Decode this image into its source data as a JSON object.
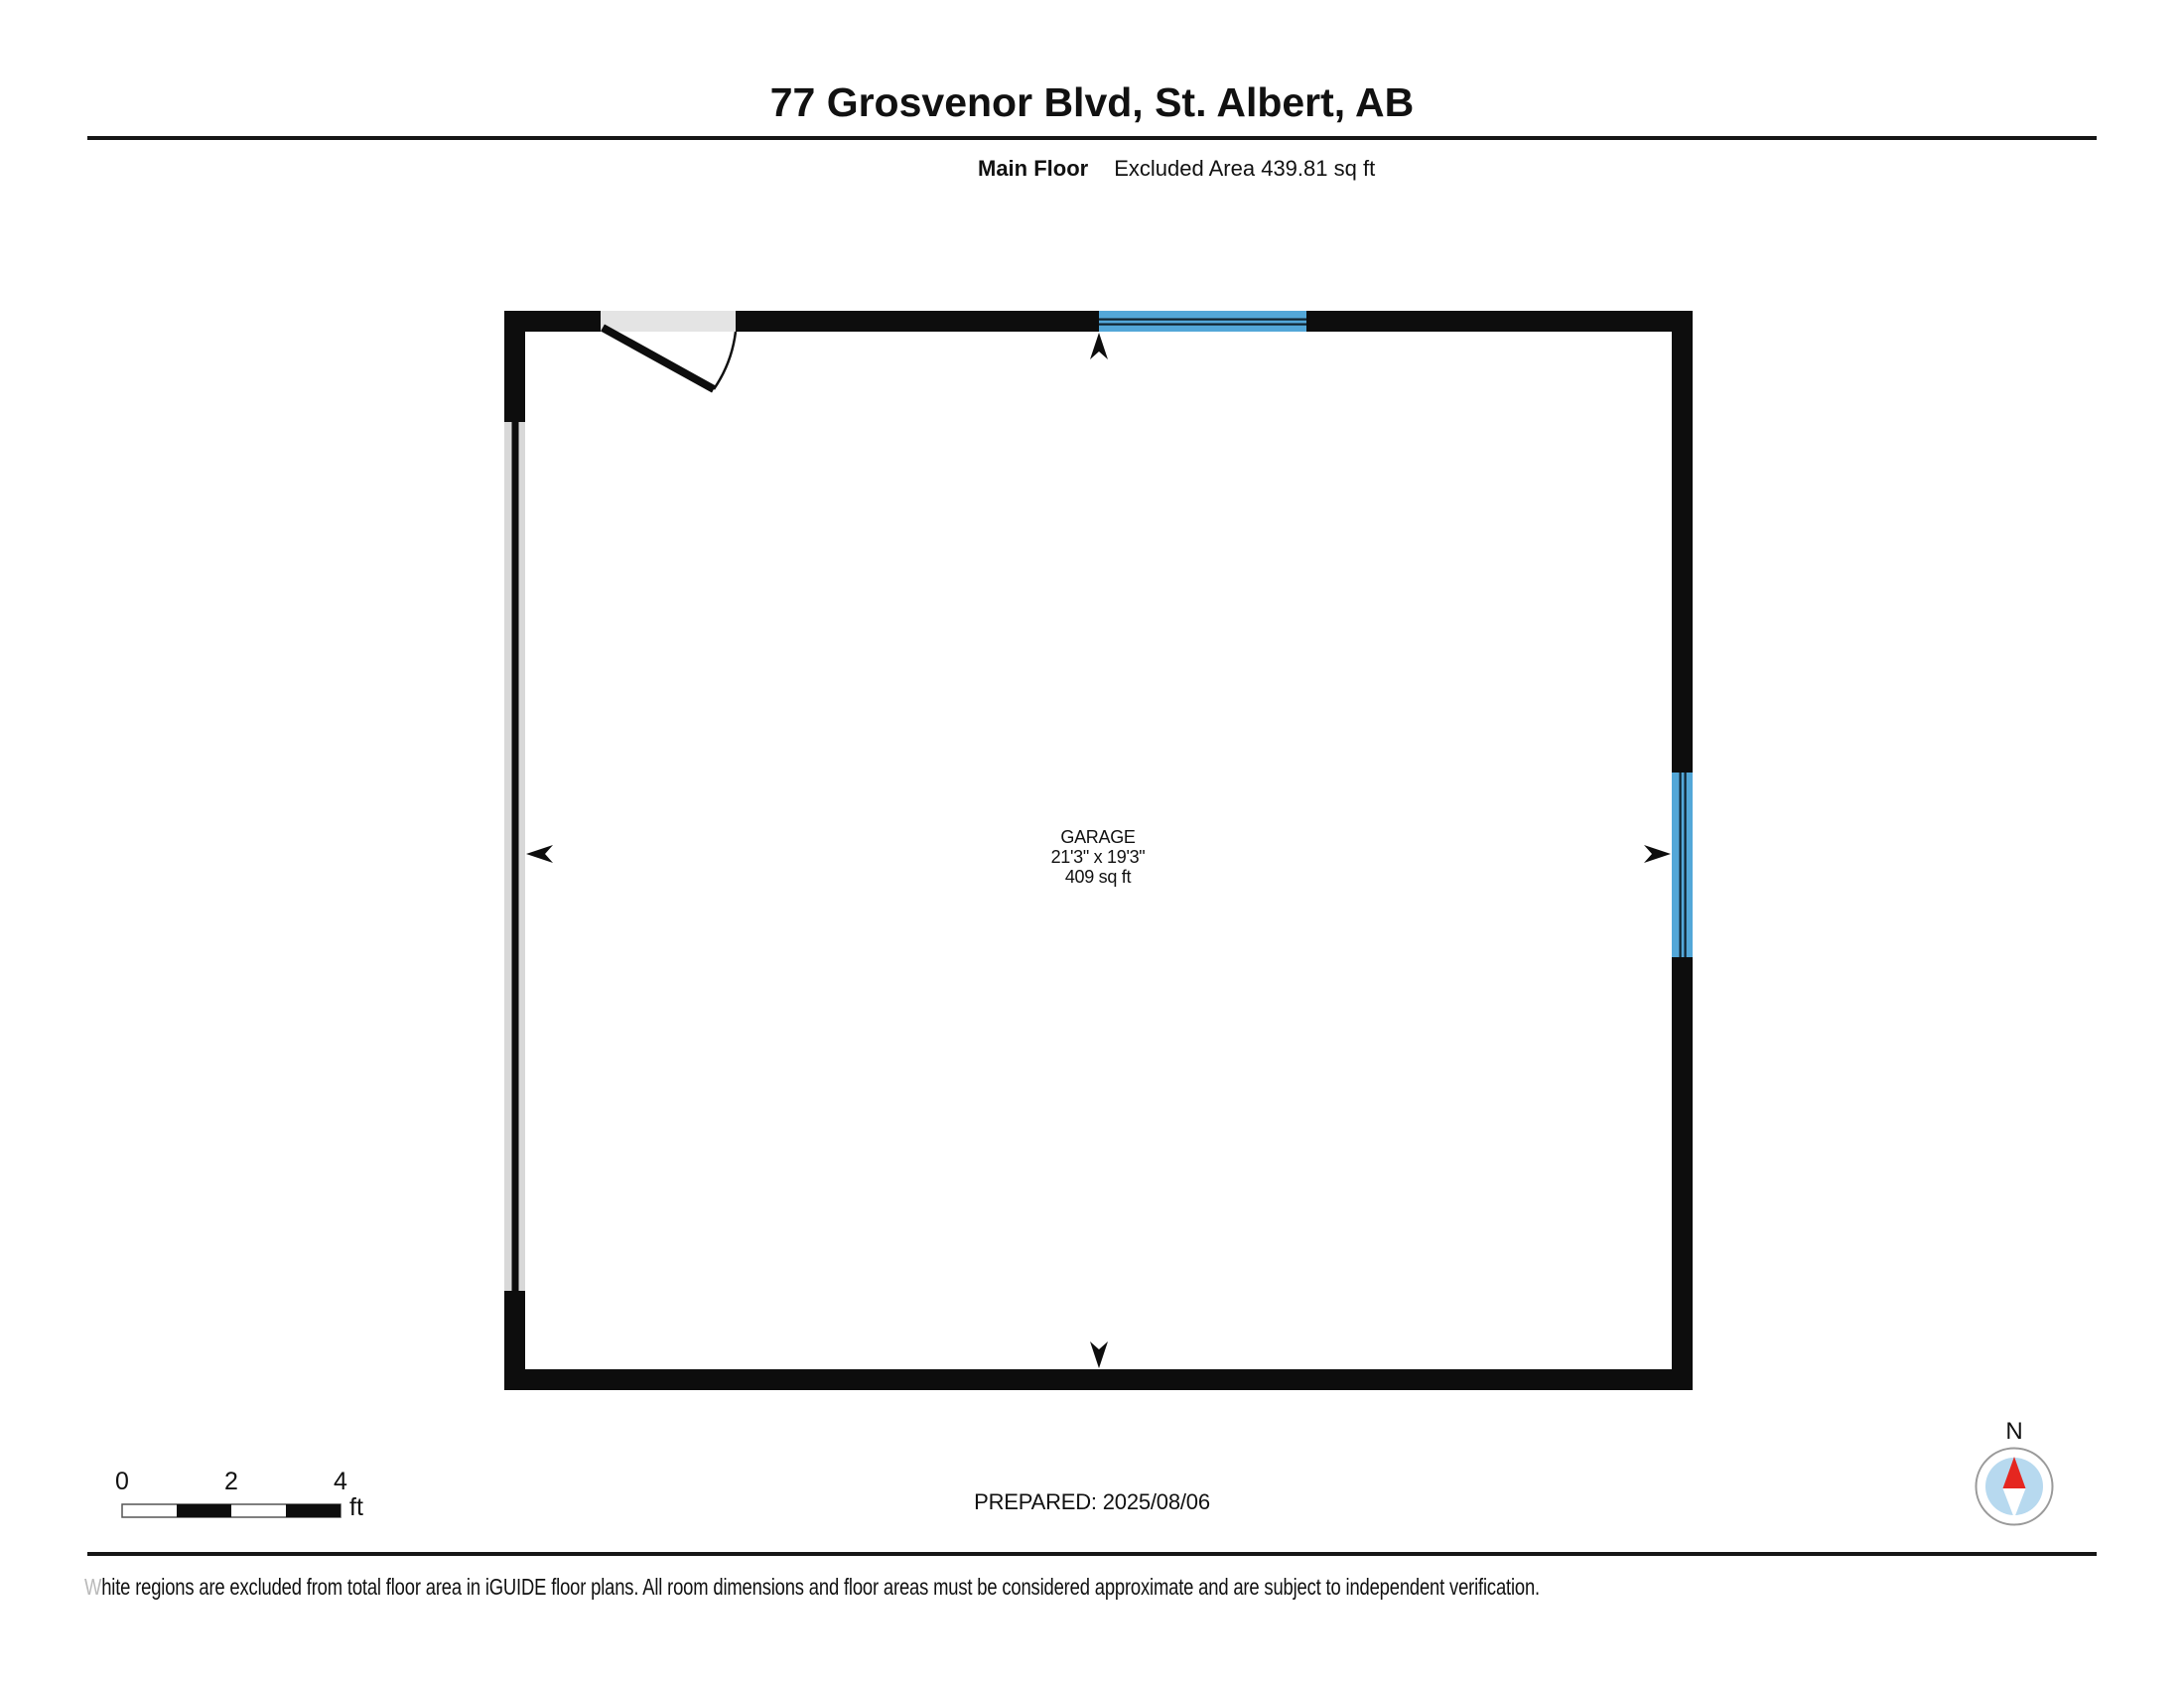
{
  "header": {
    "title": "77 Grosvenor Blvd, St. Albert, AB",
    "floor": "Main Floor",
    "excluded_area": "Excluded Area 439.81 sq ft"
  },
  "room": {
    "name": "GARAGE",
    "dimensions": "21'3\" x 19'3\"",
    "area": "409 sq ft"
  },
  "scale_bar": {
    "ticks": [
      "0",
      "2",
      "4"
    ],
    "unit": "ft"
  },
  "footer": {
    "prepared": "PREPARED: 2025/08/06",
    "disclaimer_first_letter": "W",
    "disclaimer_rest": "hite regions are excluded from total floor area in iGUIDE floor plans. All room dimensions and floor areas must be considered approximate and are subject to independent verification."
  },
  "compass": {
    "north_label": "N"
  },
  "colors": {
    "wall_black": "#0d0d0d",
    "door_opening_gray": "#e4e4e4",
    "garage_door_gray": "#d8d8d8",
    "window_blue": "#53a7d8",
    "compass_face_blue": "#b7d9ef",
    "compass_needle_red": "#e52620",
    "compass_ring_gray": "#9a9a9a"
  }
}
